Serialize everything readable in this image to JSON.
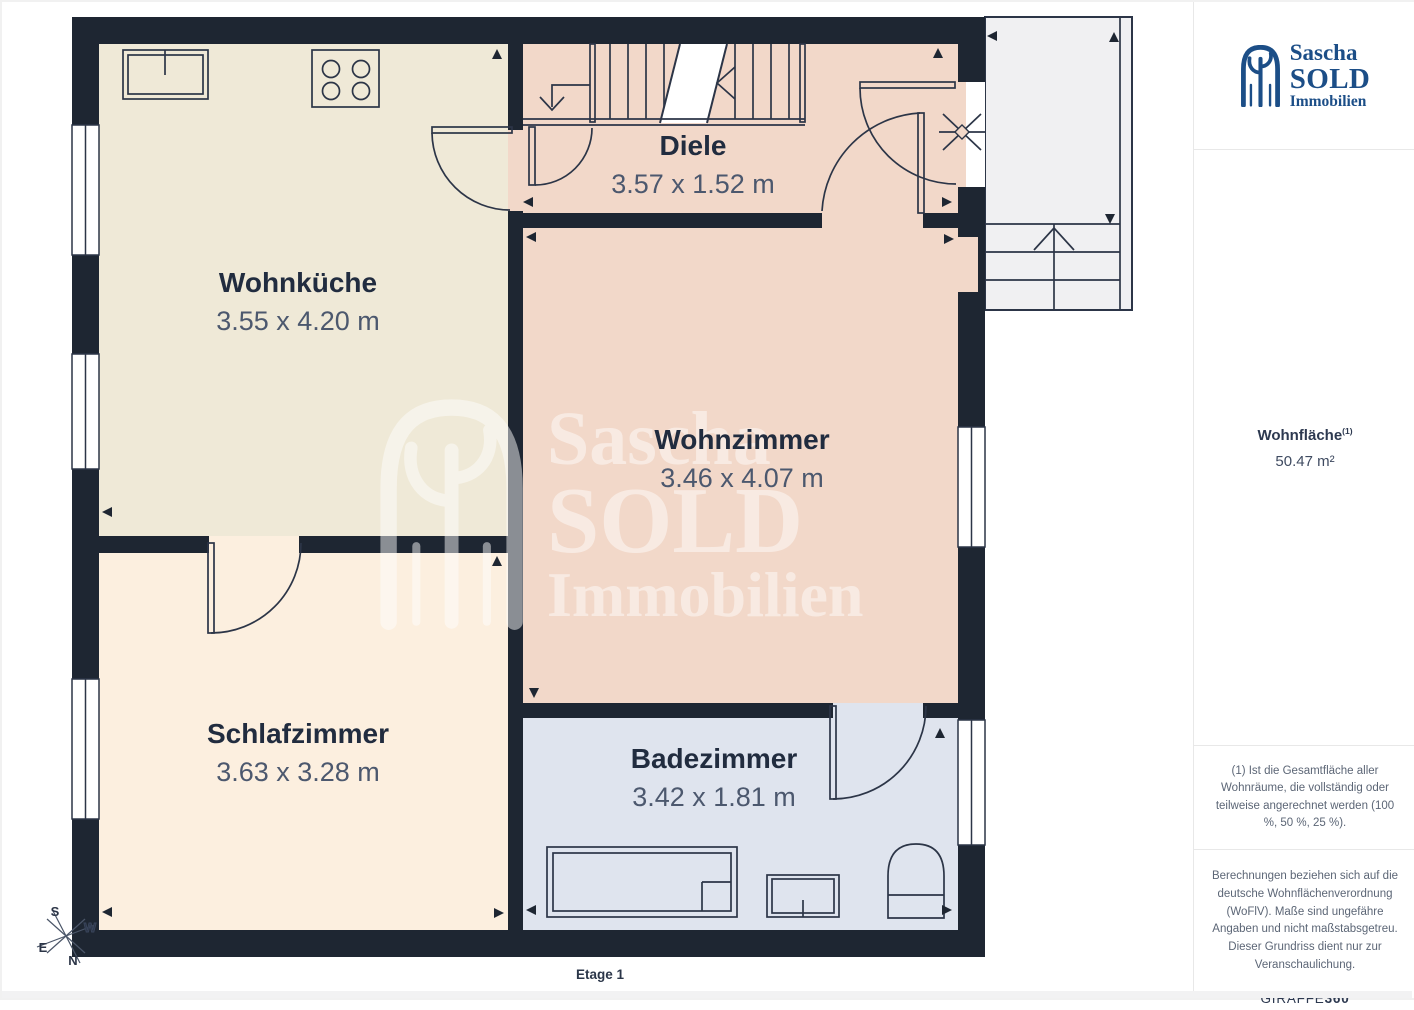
{
  "page": {
    "floor_label": "Etage 1"
  },
  "branding": {
    "line1": "Sascha",
    "line2": "SOLD",
    "line3": "Immobilien",
    "logo_color": "#1c4e87"
  },
  "colors": {
    "wall": "#1e2632",
    "exterior": "#f0f0f2"
  },
  "rooms": [
    {
      "name": "Wohnküche",
      "dimensions": "3.55 x 4.20 m",
      "color": "#efe9d7"
    },
    {
      "name": "Diele",
      "dimensions": "3.57 x 1.52 m",
      "color": "#f2d8c9"
    },
    {
      "name": "Wohnzimmer",
      "dimensions": "3.46 x 4.07 m",
      "color": "#f2d8c9"
    },
    {
      "name": "Schlafzimmer",
      "dimensions": "3.63 x 3.28 m",
      "color": "#fcefdf"
    },
    {
      "name": "Badezimmer",
      "dimensions": "3.42 x 1.81 m",
      "color": "#dfe4ee"
    }
  ],
  "compass": {
    "n": "N",
    "s": "S",
    "e": "E",
    "w": "W"
  },
  "sidebar": {
    "area_label": "Wohnfläche",
    "area_footnote_marker": "(1)",
    "area_value": "50.47 m²",
    "footnote": "(1) Ist die Gesamtfläche aller Wohnräume, die vollständig oder teilweise angerechnet werden (100 %, 50 %, 25 %).",
    "disclaimer": "Berechnungen beziehen sich auf die deutsche Wohnflächenverordnung (WoFlV). Maße sind ungefähre Angaben und nicht maßstabsgetreu. Dieser Grundriss dient nur zur Veranschaulichung.",
    "brand_giraffe": "GIRAFFE",
    "brand_360": "360"
  }
}
